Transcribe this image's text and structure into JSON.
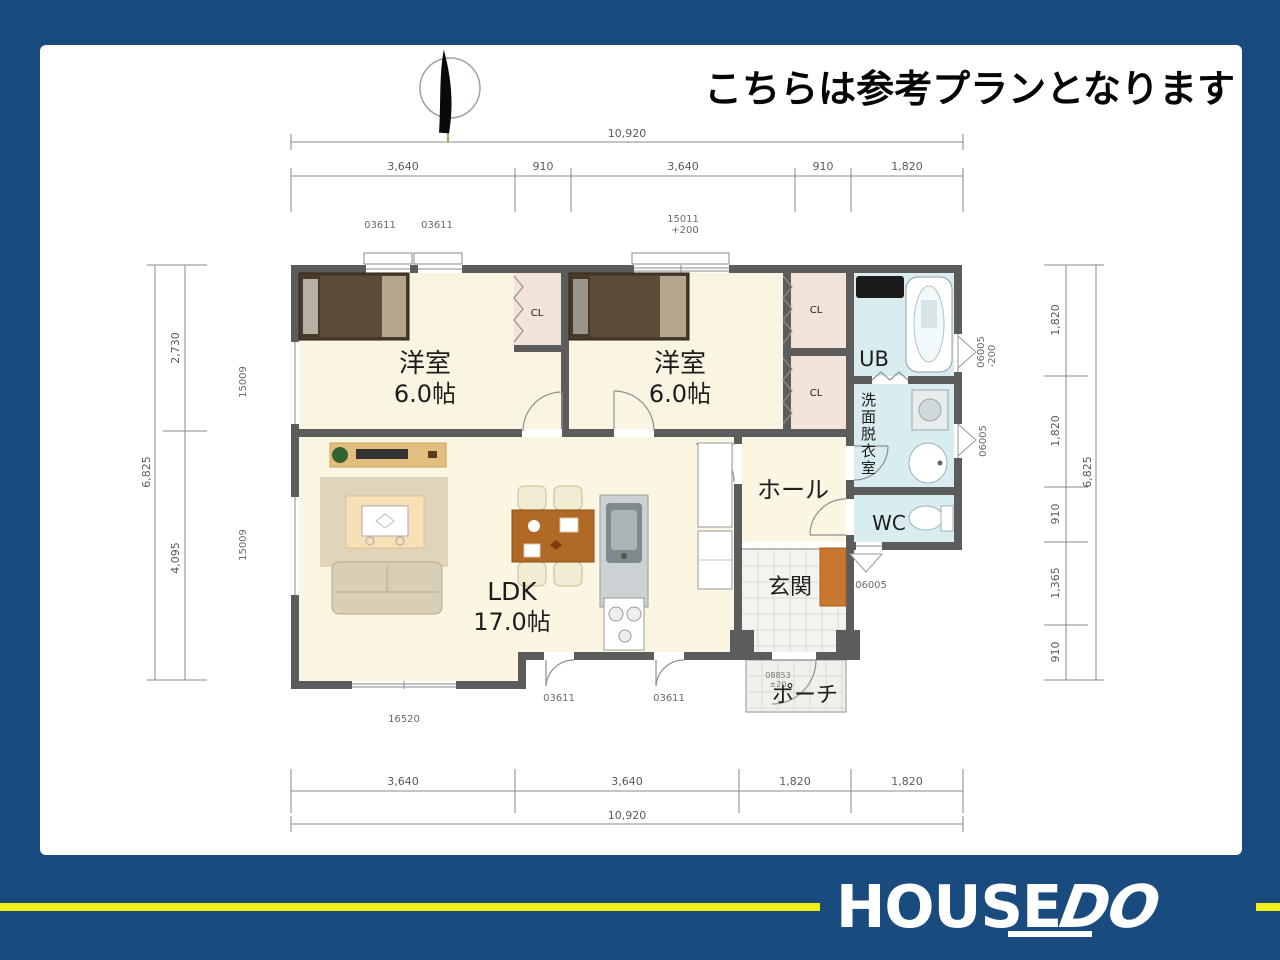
{
  "notice": "こちらは参考プランとなります",
  "rooms": {
    "bedroom1_name": "洋室",
    "bedroom1_size": "6.0帖",
    "bedroom2_name": "洋室",
    "bedroom2_size": "6.0帖",
    "ldk_name": "LDK",
    "ldk_size": "17.0帖",
    "hall": "ホール",
    "entrance": "玄関",
    "porch": "ポーチ",
    "bath": "UB",
    "washroom": "洗面脱衣室",
    "wc": "WC",
    "closet1": "CL",
    "closet2": "CL",
    "closet3": "CL"
  },
  "dims": {
    "top_total": "10,920",
    "top_segments": [
      "3,640",
      "910",
      "3,640",
      "910",
      "1,820"
    ],
    "bottom_total": "10,920",
    "bottom_segments": [
      "3,640",
      "3,640",
      "1,820",
      "1,820"
    ],
    "left_total": "6,825",
    "left_segments": [
      "2,730",
      "4,095"
    ],
    "right_total": "6,825",
    "right_segments": [
      "1,820",
      "1,820",
      "910",
      "1,365",
      "910"
    ]
  },
  "codes": {
    "top_window1": "03611",
    "top_window2": "03611",
    "top_window3": "15011",
    "top_window3_offset": "+200",
    "left_window1": "15009",
    "left_window2": "15009",
    "right_window1": "06005",
    "right_window1_offset": "-200",
    "right_window2": "06005",
    "wc_window": "06005",
    "living_window": "16520",
    "back_door1": "03611",
    "back_door2": "03611",
    "entry_door": "08853",
    "entry_door_offset": "±20"
  },
  "logo": {
    "house": "HOUSE",
    "do": "DO"
  },
  "colors": {
    "frame_navy": "#1a4b7f",
    "wall_gray": "#5c5c5c",
    "room_cream": "#f9f5e2",
    "closet_pink": "#f3e4da",
    "bath_blue": "#d9ecef",
    "logo_yellow": "#f0ef15",
    "compass_green": "#82c341"
  }
}
